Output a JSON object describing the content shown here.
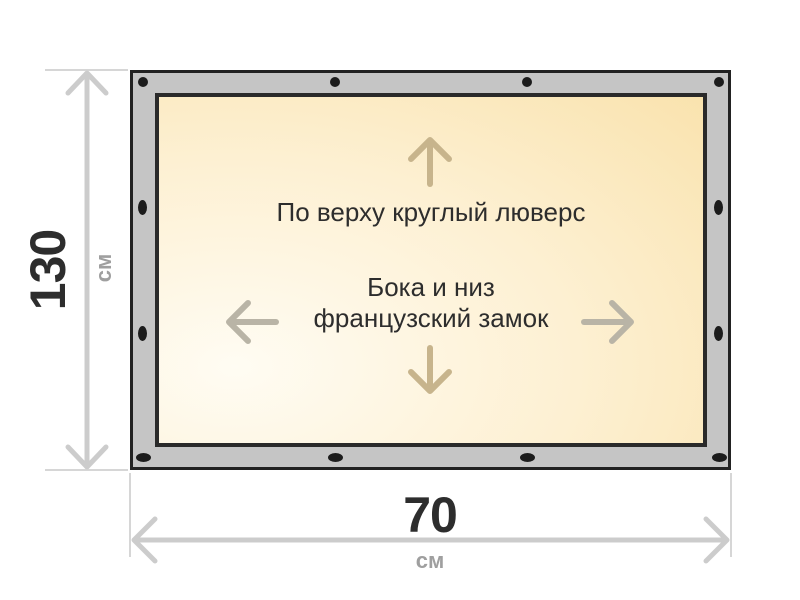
{
  "diagram": {
    "type": "product-dimension-diagram",
    "height": {
      "value": "130",
      "unit": "см"
    },
    "width": {
      "value": "70",
      "unit": "см"
    },
    "annotations": {
      "top_edge": "По верху круглый люверс",
      "sides_line1": "Бока и низ",
      "sides_line2": "французский замок"
    },
    "grommets": {
      "count": 12
    },
    "colors": {
      "frame_gray": "#c5c5c5",
      "frame_border": "#222222",
      "panel_border": "#2a2a2a",
      "panel_fill_light": "#fffcf3",
      "panel_fill_mid": "#fdf0d2",
      "panel_fill_deep": "#f8dfa4",
      "grommet": "#1c1c1c",
      "dimension_line": "#cccccc",
      "extension_line": "#d6d6d6",
      "arrow_vertical": "#c7b48c",
      "arrow_horizontal": "#b9b4a6",
      "text_dark": "#2d2d2d",
      "unit_gray": "#9f9f9f"
    }
  }
}
